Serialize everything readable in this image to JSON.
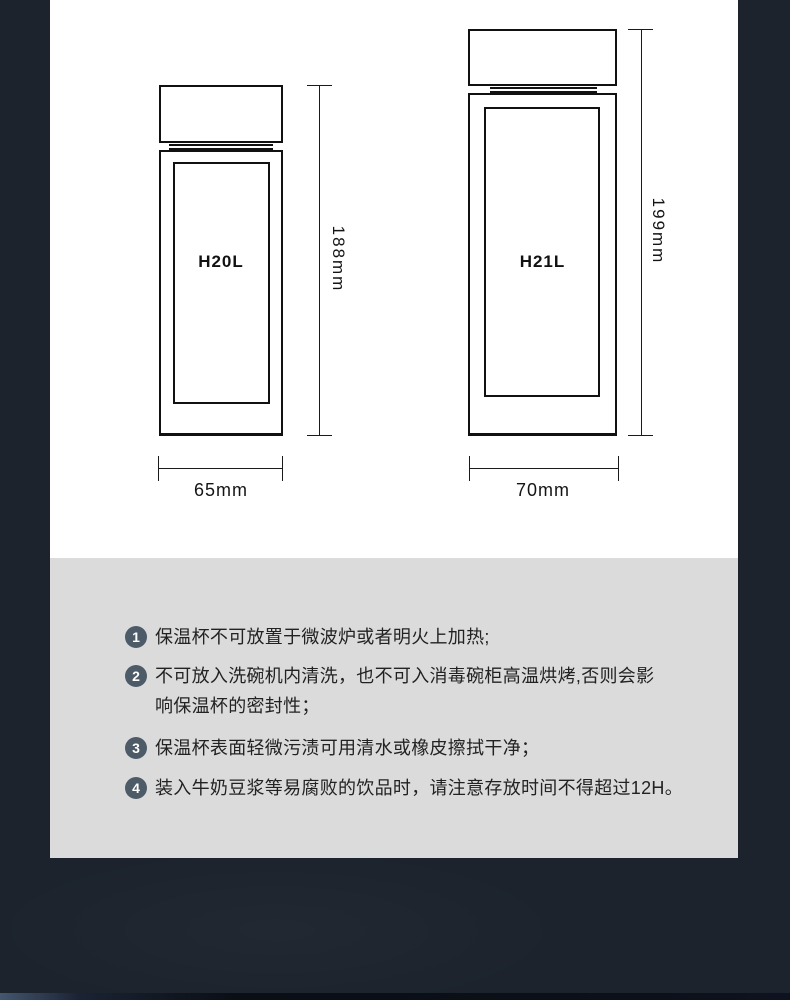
{
  "colors": {
    "background": "#1c232d",
    "spec_card": "#ffffff",
    "notes_card": "#dbdbdb",
    "badge": "#4d5a68",
    "line_art": "#111111"
  },
  "bottles": [
    {
      "model": "H20L",
      "height": "188mm",
      "width": "65mm"
    },
    {
      "model": "H21L",
      "height": "199mm",
      "width": "70mm"
    }
  ],
  "notes": [
    {
      "number": "1",
      "lines": [
        "保温杯不可放置于微波炉或者明火上加热;"
      ]
    },
    {
      "number": "2",
      "lines": [
        "不可放入洗碗机内清洗，也不可入消毒碗柜高温烘烤,否则会影",
        "响保温杯的密封性；"
      ]
    },
    {
      "number": "3",
      "lines": [
        "保温杯表面轻微污渍可用清水或橡皮擦拭干净；"
      ]
    },
    {
      "number": "4",
      "lines": [
        "装入牛奶豆浆等易腐败的饮品时，请注意存放时间不得超过12H。"
      ]
    }
  ]
}
